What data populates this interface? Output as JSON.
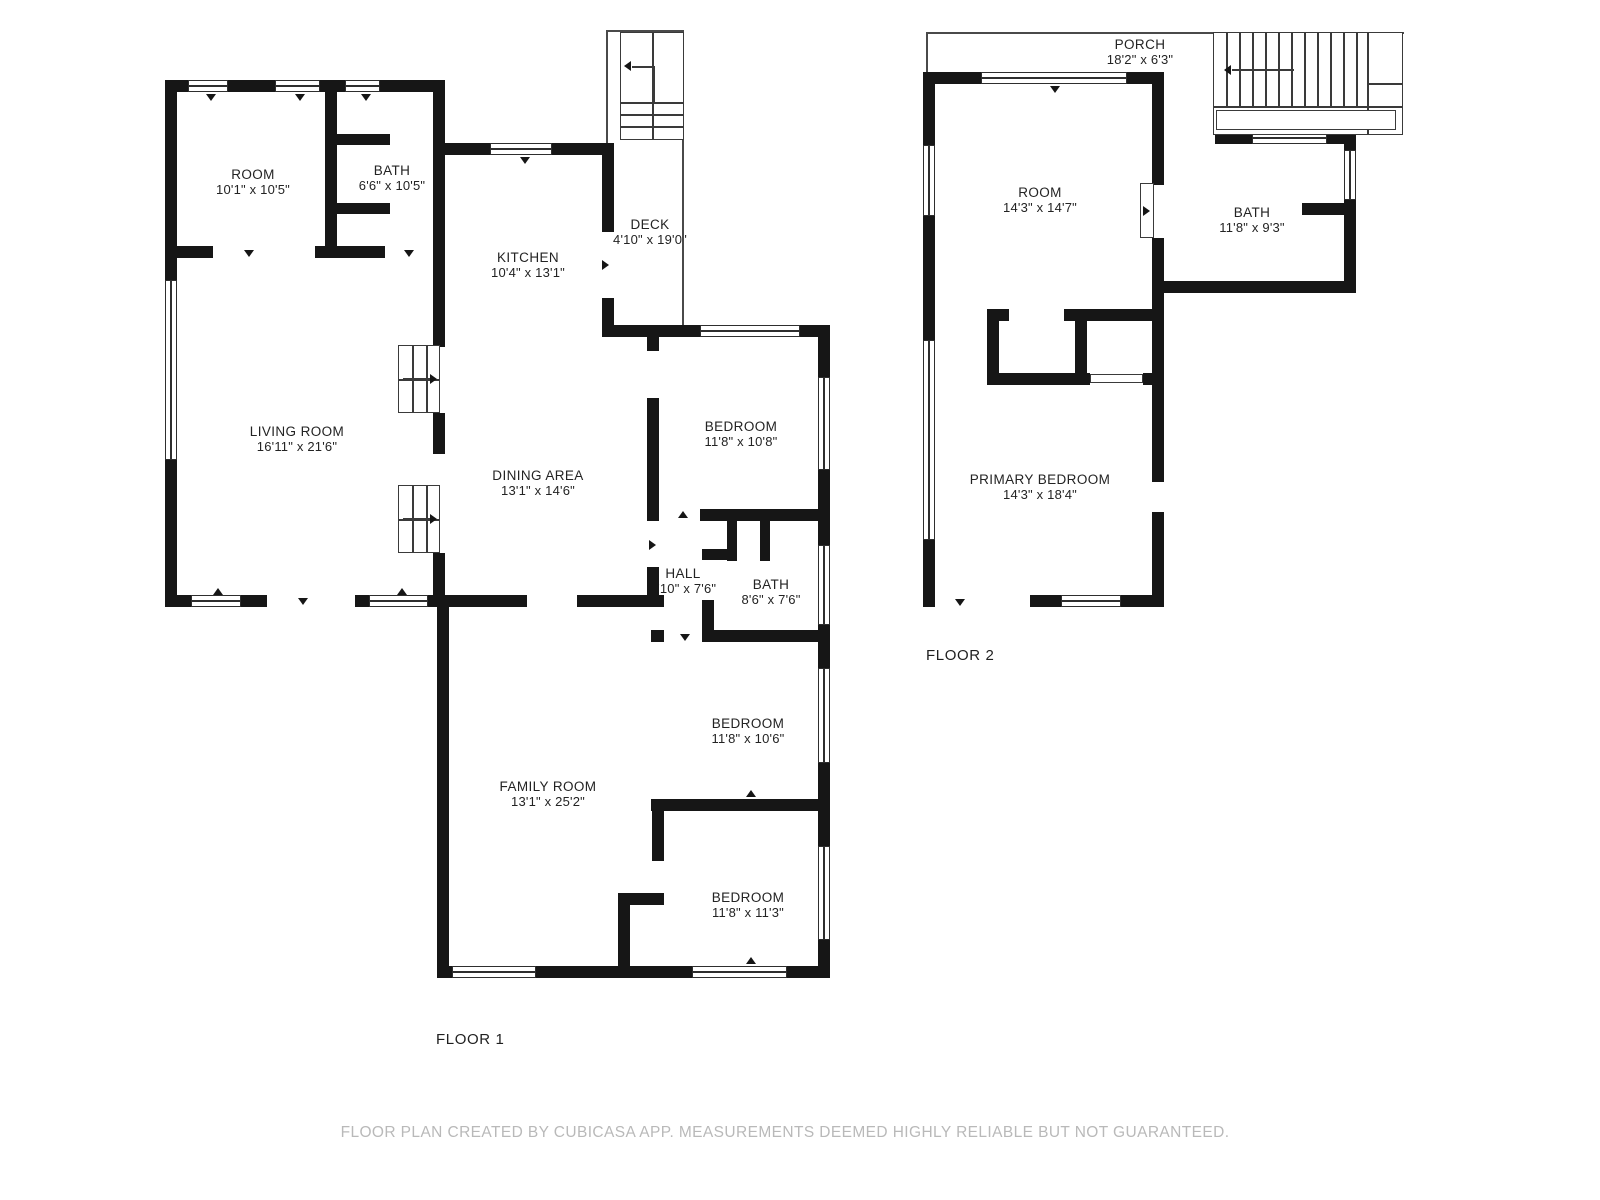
{
  "page": {
    "background": "#ffffff"
  },
  "colors": {
    "wall": "#161616",
    "thin_line": "#4a4a4a",
    "label": "#232323",
    "disclaimer": "#b9b9b9"
  },
  "floor1": {
    "caption": "FLOOR 1",
    "rooms": {
      "room": {
        "name": "ROOM",
        "dims": "10'1\" x 10'5\""
      },
      "bath_upper": {
        "name": "BATH",
        "dims": "6'6\" x 10'5\""
      },
      "kitchen": {
        "name": "KITCHEN",
        "dims": "10'4\" x 13'1\""
      },
      "deck": {
        "name": "DECK",
        "dims": "4'10\" x 19'0\""
      },
      "living_room": {
        "name": "LIVING ROOM",
        "dims": "16'11\" x 21'6\""
      },
      "dining_area": {
        "name": "DINING AREA",
        "dims": "13'1\" x 14'6\""
      },
      "bedroom_top": {
        "name": "BEDROOM",
        "dims": "11'8\" x 10'8\""
      },
      "hall": {
        "name": "HALL",
        "dims": "2'10\" x 7'6\""
      },
      "bath_lower": {
        "name": "BATH",
        "dims": "8'6\" x 7'6\""
      },
      "family_room": {
        "name": "FAMILY ROOM",
        "dims": "13'1\" x 25'2\""
      },
      "bedroom_middle": {
        "name": "BEDROOM",
        "dims": "11'8\" x 10'6\""
      },
      "bedroom_bottom": {
        "name": "BEDROOM",
        "dims": "11'8\" x 11'3\""
      }
    }
  },
  "floor2": {
    "caption": "FLOOR 2",
    "rooms": {
      "porch": {
        "name": "PORCH",
        "dims": "18'2\" x 6'3\""
      },
      "room": {
        "name": "ROOM",
        "dims": "14'3\" x 14'7\""
      },
      "bath": {
        "name": "BATH",
        "dims": "11'8\" x 9'3\""
      },
      "primary_bedroom": {
        "name": "PRIMARY BEDROOM",
        "dims": "14'3\" x 18'4\""
      }
    }
  },
  "footer": {
    "disclaimer": "FLOOR PLAN CREATED BY CUBICASA APP. MEASUREMENTS DEEMED HIGHLY RELIABLE BUT NOT GUARANTEED."
  }
}
